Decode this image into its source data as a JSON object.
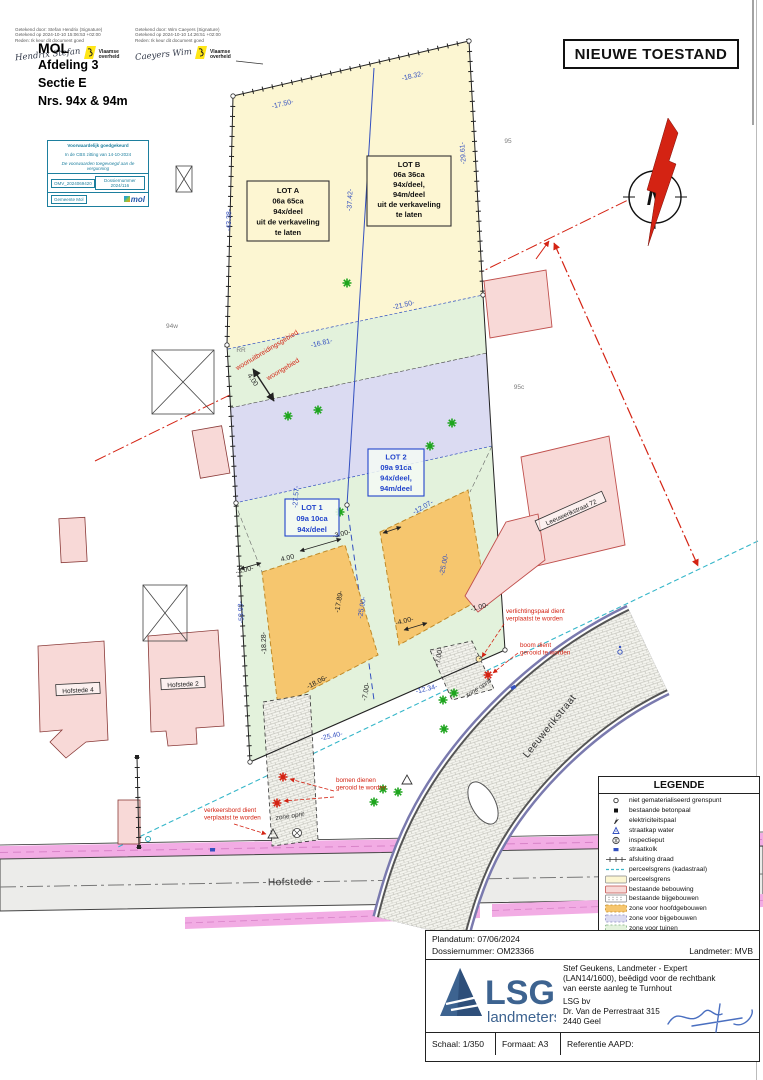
{
  "title_box": {
    "label": "NIEUWE TOESTAND"
  },
  "signature_stamps": {
    "left": {
      "line1": "Getekend door: Stefan Hendrix (Signature)",
      "line2": "Getekend op 2024-10-10 15:06:53 +02:00",
      "line3": "Reden: Ik keur dit document goed",
      "signature": "Hendrix Stefan",
      "org_line1": "Vlaamse",
      "org_line2": "overheid"
    },
    "right": {
      "line1": "Getekend door: Wim Caeyers (Signature)",
      "line2": "Getekend op 2024-10-10 14:26:51 +02:00",
      "line3": "Reden: Ik keur dit document goed",
      "signature": "Caeyers Wim",
      "org_line1": "Vlaamse",
      "org_line2": "overheid"
    }
  },
  "header": {
    "municipality": "MOL",
    "line1": "Afdeling 3",
    "line2": "Sectie E",
    "line3": "Nrs. 94x & 94m"
  },
  "approval_box": {
    "row1": "Voorwaardelijk goedgekeurd",
    "row2": "In de CBS zitting van 14-10-2024",
    "row3": "De voorwaarden toegevoegd aan de vergunning",
    "row4_left": "OMV_2024069420",
    "row4_right": "Dossiernummer 2024/116",
    "row5_left": "Gemeente Mol",
    "logo_text": "mol"
  },
  "north_arrow": {
    "label": "N"
  },
  "plan": {
    "lot_boxes": {
      "lot_a": {
        "lines": [
          "LOT A",
          "06a 65ca",
          "94x/deel",
          "uit de verkaveling",
          "te laten"
        ]
      },
      "lot_b": {
        "lines": [
          "LOT B",
          "06a 36ca",
          "94x/deel,",
          "94m/deel",
          "uit de verkaveling",
          "te laten"
        ]
      },
      "lot_1": {
        "lines": [
          "LOT 1",
          "09a 10ca",
          "94x/deel"
        ]
      },
      "lot_2": {
        "lines": [
          "LOT 2",
          "09a 91ca",
          "94x/deel,",
          "94m/deel"
        ]
      }
    },
    "street_labels": [
      {
        "text": "Hofstede",
        "x": 290,
        "y": 885,
        "r": -1,
        "size": 10
      },
      {
        "text": "Leeuwerikstraat",
        "x": 552,
        "y": 728,
        "r": -51,
        "size": 10
      }
    ],
    "building_labels": [
      {
        "text": "Hofstede 4",
        "x": 78,
        "y": 690,
        "r": -3
      },
      {
        "text": "Hofstede 2",
        "x": 183,
        "y": 684,
        "r": -3
      },
      {
        "text": "Leeuwerikstraat 72",
        "x": 571,
        "y": 512,
        "r": -24
      }
    ],
    "dimensions": [
      {
        "t": "-17.50-",
        "x": 283,
        "y": 106,
        "r": -13,
        "c": "b"
      },
      {
        "t": "-18.32-",
        "x": 413,
        "y": 78,
        "r": -13,
        "c": "b"
      },
      {
        "t": "-37.42-",
        "x": 352,
        "y": 200,
        "r": -87,
        "c": "b"
      },
      {
        "t": "-29.61-",
        "x": 465,
        "y": 153,
        "r": -94,
        "c": "b"
      },
      {
        "t": "-43.38-",
        "x": 231,
        "y": 220,
        "r": -89,
        "c": "b"
      },
      {
        "t": "-21.50-",
        "x": 404,
        "y": 307,
        "r": -13,
        "c": "b"
      },
      {
        "t": "-16.81-",
        "x": 322,
        "y": 345,
        "r": -13,
        "c": "b"
      },
      {
        "t": "-27.57-",
        "x": 298,
        "y": 497,
        "r": -85,
        "c": "b"
      },
      {
        "t": "-53.93-",
        "x": 243,
        "y": 612,
        "r": -93,
        "c": "b"
      },
      {
        "t": "-25.00-",
        "x": 446,
        "y": 565,
        "r": -78,
        "c": "b"
      },
      {
        "t": "-25.00-",
        "x": 364,
        "y": 608,
        "r": -80,
        "c": "b"
      },
      {
        "t": "-12.07-",
        "x": 424,
        "y": 509,
        "r": -30,
        "c": "b"
      },
      {
        "t": "-17.89-",
        "x": 341,
        "y": 602,
        "r": -80,
        "c": "k"
      },
      {
        "t": "-18.28-",
        "x": 266,
        "y": 643,
        "r": -92,
        "c": "k"
      },
      {
        "t": "-18.06-",
        "x": 318,
        "y": 684,
        "r": -27,
        "c": "k"
      },
      {
        "t": "-7.00-",
        "x": 368,
        "y": 692,
        "r": -80,
        "c": "k"
      },
      {
        "t": "-7.00-",
        "x": 441,
        "y": 657,
        "r": -80,
        "c": "k"
      },
      {
        "t": "-12.34-",
        "x": 427,
        "y": 691,
        "r": -14,
        "c": "b"
      },
      {
        "t": "-25.40-",
        "x": 332,
        "y": 738,
        "r": -12,
        "c": "b"
      },
      {
        "t": "4.00",
        "x": 288,
        "y": 560,
        "r": -14,
        "c": "k"
      },
      {
        "t": "-3.00-",
        "x": 245,
        "y": 572,
        "r": -14,
        "c": "k"
      },
      {
        "t": "-3.00-",
        "x": 342,
        "y": 536,
        "r": -14,
        "c": "k"
      },
      {
        "t": "-4.00-",
        "x": 405,
        "y": 623,
        "r": -14,
        "c": "k"
      },
      {
        "t": "-1.00-",
        "x": 480,
        "y": 609,
        "r": -14,
        "c": "k"
      },
      {
        "t": "4.00",
        "x": 251,
        "y": 381,
        "r": 55,
        "c": "k"
      }
    ],
    "gray_labels": [
      {
        "text": "95",
        "x": 508,
        "y": 143
      },
      {
        "text": "95c",
        "x": 519,
        "y": 389
      },
      {
        "text": "94w",
        "x": 172,
        "y": 328
      },
      {
        "text": "RR",
        "x": 241,
        "y": 352
      }
    ],
    "zone_labels": [
      {
        "text": "zone oprit",
        "x": 290,
        "y": 818,
        "r": -8
      },
      {
        "text": "zone oprit",
        "x": 479,
        "y": 690,
        "r": -33
      }
    ],
    "red_zone_labels": [
      {
        "text": "woonuitbreidingsgebied",
        "x": 268,
        "y": 352,
        "r": -31
      },
      {
        "text": "woongebied",
        "x": 284,
        "y": 371,
        "r": -31
      }
    ],
    "red_annotations": [
      {
        "lines": [
          "verlichtingspaal dient",
          "verplaatst te worden"
        ],
        "x": 506,
        "y": 613
      },
      {
        "lines": [
          "boom dient",
          "gerooid te worden"
        ],
        "x": 520,
        "y": 647
      },
      {
        "lines": [
          "bomen dienen",
          "gerooid te worden"
        ],
        "x": 336,
        "y": 782
      },
      {
        "lines": [
          "verkeersbord dient",
          "verplaatst te worden"
        ],
        "x": 204,
        "y": 812
      }
    ],
    "trees": {
      "green": [
        [
          347,
          283
        ],
        [
          288,
          416
        ],
        [
          318,
          410
        ],
        [
          430,
          446
        ],
        [
          452,
          423
        ],
        [
          340,
          512
        ],
        [
          443,
          700
        ],
        [
          454,
          693
        ],
        [
          444,
          729
        ],
        [
          374,
          802
        ],
        [
          398,
          792
        ],
        [
          383,
          789
        ]
      ],
      "red": [
        [
          283,
          777
        ],
        [
          277,
          803
        ],
        [
          488,
          675
        ]
      ]
    }
  },
  "legend": {
    "title": "LEGENDE",
    "items": [
      {
        "symbol": "point-circle",
        "label": "niet gematerialiseerd grenspunt"
      },
      {
        "symbol": "square-black",
        "label": "bestaande betonpaal"
      },
      {
        "symbol": "elec-pole",
        "label": "elektriciteitspaal"
      },
      {
        "symbol": "water-cap",
        "label": "straatkap water"
      },
      {
        "symbol": "inspection-pit",
        "label": "inspectieput"
      },
      {
        "symbol": "street-gully",
        "label": "straatkolk"
      },
      {
        "symbol": "fence-line",
        "label": "afsluiting draad"
      },
      {
        "symbol": "cadastral-line",
        "label": "perceelsgrens (kadastraal)"
      },
      {
        "symbol": "parcel-swatch",
        "label": "perceelsgrens"
      },
      {
        "symbol": "building-swatch",
        "label": "bestaande bebouwing"
      },
      {
        "symbol": "outbuilding-swatch",
        "label": "bestaande bijgebouwen"
      },
      {
        "symbol": "main-zone-swatch",
        "label": "zone voor hoofdgebouwen"
      },
      {
        "symbol": "annex-zone-swatch",
        "label": "zone voor bijgebouwen"
      },
      {
        "symbol": "garden-zone-swatch",
        "label": "zone voor tuinen"
      }
    ]
  },
  "title_block": {
    "plandatum": "Plandatum: 07/06/2024",
    "dossier": "Dossiernummer: OM23366",
    "landmeter": "Landmeter: MVB",
    "logo_main": "LSG",
    "logo_sub": "landmeters",
    "surveyor_lines": [
      "Stef Geukens, Landmeter - Expert",
      "(LAN14/1600), beëdigd voor de rechtbank",
      "van eerste aanleg te Turnhout"
    ],
    "company_lines": [
      "LSG bv",
      "Dr. Van de Perrestraat 315",
      "2440 Geel"
    ],
    "schaal": "Schaal: 1/350",
    "formaat": "Formaat: A3",
    "referentie": "Referentie AAPD:"
  },
  "colors": {
    "yellow": "#FCF6D2",
    "lavender": "#DBDBF2",
    "green": "#E3F2DC",
    "orange": "#F6C66E",
    "pink": "#F8D9D7",
    "pink_border": "#C0504D",
    "magenta": "#F2ACE4",
    "blue_dim": "#3350C0",
    "teal": "#35B6C9",
    "red": "#D42313"
  }
}
